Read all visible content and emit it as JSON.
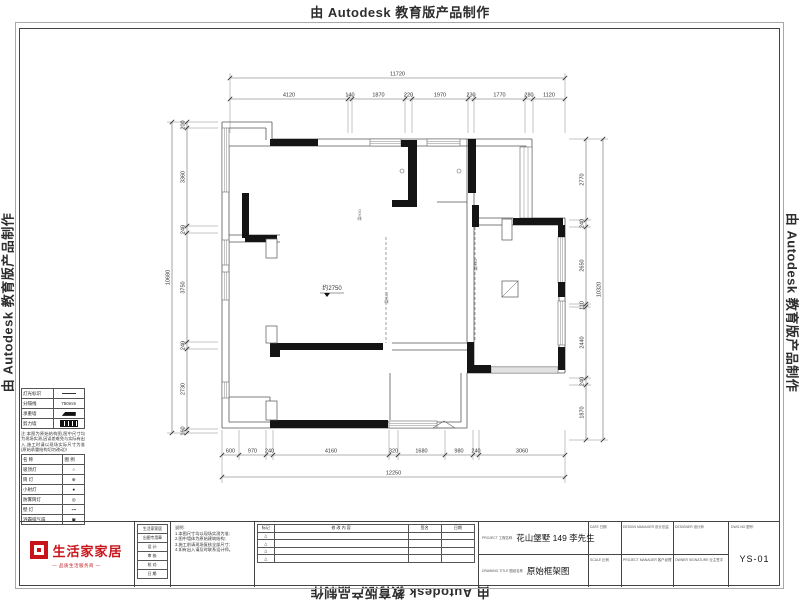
{
  "watermark": {
    "text": "由 Autodesk 教育版产品制作"
  },
  "plan": {
    "elevation": "约2750",
    "beam_label": "梁H30",
    "thin": [
      [
        222,
        122,
        272,
        122
      ],
      [
        222,
        122,
        222,
        428
      ],
      [
        272,
        122,
        272,
        139
      ],
      [
        272,
        139,
        532,
        139
      ],
      [
        532,
        139,
        532,
        218
      ],
      [
        532,
        218,
        565,
        218
      ],
      [
        565,
        218,
        565,
        373
      ],
      [
        565,
        373,
        467,
        373
      ],
      [
        467,
        373,
        467,
        428
      ],
      [
        467,
        428,
        222,
        428
      ],
      [
        229,
        146,
        526,
        146
      ],
      [
        229,
        146,
        229,
        422
      ],
      [
        229,
        128,
        266,
        128
      ],
      [
        266,
        128,
        266,
        140
      ],
      [
        229,
        422,
        461,
        422
      ],
      [
        461,
        422,
        461,
        373
      ],
      [
        526,
        146,
        526,
        218
      ],
      [
        478,
        225,
        559,
        225
      ],
      [
        478,
        218,
        513,
        218
      ],
      [
        559,
        225,
        559,
        367
      ],
      [
        474,
        367,
        559,
        367
      ],
      [
        229,
        235,
        280,
        235
      ],
      [
        229,
        242,
        280,
        242
      ],
      [
        467,
        139,
        467,
        342
      ],
      [
        474,
        147,
        474,
        365
      ],
      [
        437,
        202,
        467,
        202
      ],
      [
        392,
        343,
        467,
        343
      ],
      [
        392,
        350,
        467,
        350
      ],
      [
        390,
        373,
        390,
        420
      ],
      [
        222,
        397,
        270,
        397
      ],
      [
        270,
        397,
        270,
        420
      ]
    ],
    "walls": [
      [
        270,
        139,
        48,
        7
      ],
      [
        401,
        140,
        16,
        7
      ],
      [
        408,
        147,
        9,
        60
      ],
      [
        392,
        200,
        25,
        7
      ],
      [
        468,
        139,
        8,
        54
      ],
      [
        472,
        205,
        7,
        22
      ],
      [
        513,
        218,
        50,
        7
      ],
      [
        558,
        225,
        7,
        12
      ],
      [
        242,
        193,
        7,
        45
      ],
      [
        245,
        235,
        32,
        7
      ],
      [
        270,
        343,
        113,
        7
      ],
      [
        270,
        350,
        10,
        7
      ],
      [
        270,
        420,
        118,
        8
      ],
      [
        467,
        342,
        7,
        31
      ],
      [
        474,
        365,
        17,
        8
      ],
      [
        558,
        347,
        7,
        23
      ],
      [
        558,
        282,
        7,
        15
      ]
    ],
    "windows": [
      [
        222,
        128,
        7,
        64
      ],
      [
        222,
        240,
        7,
        25
      ],
      [
        222,
        272,
        7,
        28
      ],
      [
        222,
        382,
        7,
        16
      ],
      [
        370,
        139,
        31,
        7
      ],
      [
        427,
        139,
        33,
        7
      ],
      [
        520,
        147,
        12,
        71
      ],
      [
        558,
        237,
        7,
        46
      ],
      [
        558,
        301,
        7,
        44
      ],
      [
        491,
        367,
        67,
        6
      ],
      [
        389,
        421,
        48,
        7
      ]
    ],
    "dashed": [
      [
        386,
        237,
        386,
        343
      ],
      [
        475,
        227,
        475,
        340
      ]
    ],
    "pilasters": [
      [
        266,
        239,
        11,
        19
      ],
      [
        266,
        326,
        11,
        17
      ],
      [
        266,
        401,
        11,
        19
      ],
      [
        502,
        219,
        10,
        21
      ]
    ],
    "flue": [
      502,
      281,
      16,
      16
    ],
    "circles": [
      [
        402,
        171
      ],
      [
        459,
        171
      ]
    ],
    "door_triangle": [
      [
        433,
        428
      ],
      [
        455,
        428
      ],
      [
        444,
        421
      ]
    ],
    "beams": [
      [
        361,
        215
      ],
      [
        388,
        298
      ],
      [
        477,
        265
      ]
    ],
    "elevation_pos": [
      332,
      290
    ]
  },
  "dims": [
    {
      "o": "h",
      "seg": 99,
      "tot": 78,
      "ext": [
        133,
        94,
        73
      ],
      "ticks": [
        230,
        348,
        352,
        405,
        412,
        468,
        474,
        525,
        533,
        565
      ],
      "labels": [
        "4120",
        "140",
        "1870",
        "220",
        "1970",
        "230",
        "1770",
        "280",
        "1120"
      ],
      "total": "11720"
    },
    {
      "o": "h",
      "seg": 455,
      "tot": 477,
      "ext": [
        430,
        460,
        483
      ],
      "ticks": [
        222,
        239,
        266,
        273,
        389,
        398,
        445,
        473,
        479,
        565
      ],
      "labels": [
        "600",
        "970",
        "240",
        "4160",
        "320",
        "1680",
        "980",
        "240",
        "3060"
      ],
      "total": "12250"
    },
    {
      "o": "v",
      "seg": 187,
      "tot": 172,
      "ext": [
        218,
        182,
        167
      ],
      "ticks": [
        122,
        128,
        226,
        233,
        342,
        349,
        429,
        433
      ],
      "labels": [
        "200",
        "3360",
        "240",
        "3750",
        "240",
        "2730",
        "160"
      ],
      "total": "10680"
    },
    {
      "o": "v",
      "seg": 586,
      "tot": 603,
      "ext": [
        569,
        591,
        608
      ],
      "ticks": [
        139,
        220,
        227,
        304,
        307,
        378,
        385,
        440
      ],
      "labels": [
        "2770",
        "240",
        "2650",
        "110",
        "2440",
        "240",
        "1870"
      ],
      "total": "10320"
    }
  ],
  "legend": {
    "wall_table": [
      {
        "label": "灯光标识",
        "sym": "line",
        "text": ""
      },
      {
        "label": "分隔线",
        "sym": "text",
        "text": "750mm"
      },
      {
        "label": "承重墙",
        "sym": "solid",
        "text": ""
      },
      {
        "label": "剪力墙",
        "sym": "hatch",
        "text": ""
      }
    ],
    "note": "注:本图为原始结构图,图中尺寸均为现场实测,因误差难免与实际有出入,施工时请以现场实际尺寸为准(原始承重结构切勿改动)!",
    "symbol_table": {
      "header": [
        "名 称",
        "图 例"
      ],
      "rows": [
        [
          "吸顶灯",
          "○"
        ],
        [
          "筒 灯",
          "⊕"
        ],
        [
          "小射灯",
          "●"
        ],
        [
          "防雾筒灯",
          "◎"
        ],
        [
          "壁 灯",
          "⊶"
        ],
        [
          "浴霸排气扇",
          "▣"
        ]
      ]
    }
  },
  "title_block": {
    "logo": {
      "name": "生活家家居",
      "tagline": "— 品质生活服务商 —",
      "color": "#c8151c"
    },
    "company_rows": [
      "生活家家居",
      "出图专用章",
      "设 计:",
      "审 核:",
      "校 对:",
      "日 期:"
    ],
    "notes_lines": [
      "说明:",
      "1.本图尺寸均以现场实测为准;",
      "2.图中墙体为原始建筑结构;",
      "3.施工前请现场复核全部尺寸;",
      "4.如有出入请及时联系设计师。"
    ],
    "revision": {
      "headers": [
        "标记",
        "修 改 内 容",
        "签名",
        "日期"
      ],
      "mark": "△",
      "rows": 4
    },
    "project": {
      "en": "PROJECT",
      "zh": "工程名称",
      "value": "花山堡墅 149 李先生"
    },
    "drawing": {
      "en": "DRAWING TITLE",
      "zh": "图纸名称",
      "value": "原始框架图"
    },
    "fields": [
      {
        "en": "DATE",
        "zh": "日期"
      },
      {
        "en": "DESIGN MANAGER",
        "zh": "设计总监"
      },
      {
        "en": "DESIGNER",
        "zh": "设计师"
      },
      {
        "en": "SCALE",
        "zh": "比例"
      },
      {
        "en": "PROJECT MANAGER",
        "zh": "客户经理"
      },
      {
        "en": "OWNER SIGNATURE",
        "zh": "业主签字"
      }
    ],
    "dwg": {
      "en": "DWG.NO",
      "zh": "图号:",
      "no": "YS-01"
    }
  }
}
